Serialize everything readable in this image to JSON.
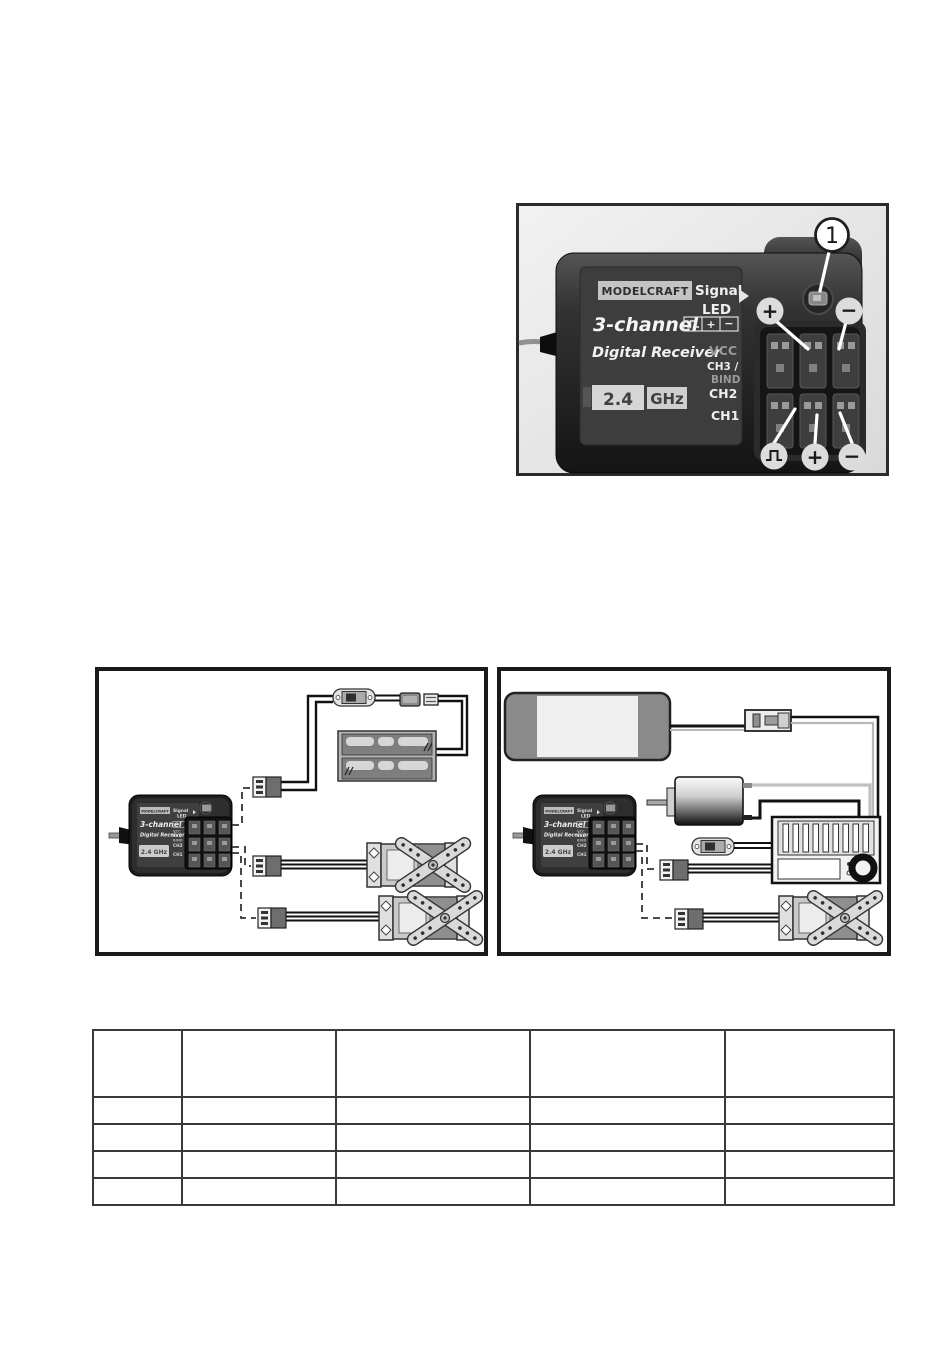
{
  "document": {
    "background": "#ffffff",
    "frame_color": "#1a1a1a"
  },
  "photo": {
    "callout_number": "1",
    "case_marking": "2.4",
    "brand": "MODELCRAFT",
    "signal": "Signal",
    "led": "LED",
    "channels": "3-channel",
    "product": "Digital Receiver",
    "band": "2.4 GHz",
    "band_num": "2.4",
    "band_unit": "GHz",
    "label_icons": {
      "pulse": "⎍",
      "plus": "+",
      "minus": "−"
    },
    "pin_labels": {
      "vcc": "VCC",
      "ch3": "CH3 /",
      "bind": "BIND",
      "ch2": "CH2",
      "ch1": "CH1"
    },
    "annotations": {
      "top_plus": "+",
      "top_minus": "−",
      "bottom_pulse": "⎍",
      "bottom_plus": "+",
      "bottom_minus": "−"
    }
  },
  "mini_receiver": {
    "brand": "MODELCRAFT",
    "signal": "Signal",
    "led": "LED",
    "channels": "3-channel",
    "product": "Digital Receiver",
    "band": "2.4 GHz",
    "pins": [
      "VCC",
      "CH3/",
      "BIND",
      "CH2",
      "CH1"
    ]
  },
  "colors": {
    "photo_background": "#e4e4e4",
    "case_dark": "#1e1e1e",
    "annotation_circle": "#dcdcdc"
  },
  "table": {
    "columns": [
      "",
      "",
      "",
      "",
      ""
    ],
    "rows": [
      [
        "",
        "",
        "",
        "",
        ""
      ],
      [
        "",
        "",
        "",
        "",
        ""
      ],
      [
        "",
        "",
        "",
        "",
        ""
      ],
      [
        "",
        "",
        "",
        "",
        ""
      ]
    ]
  }
}
